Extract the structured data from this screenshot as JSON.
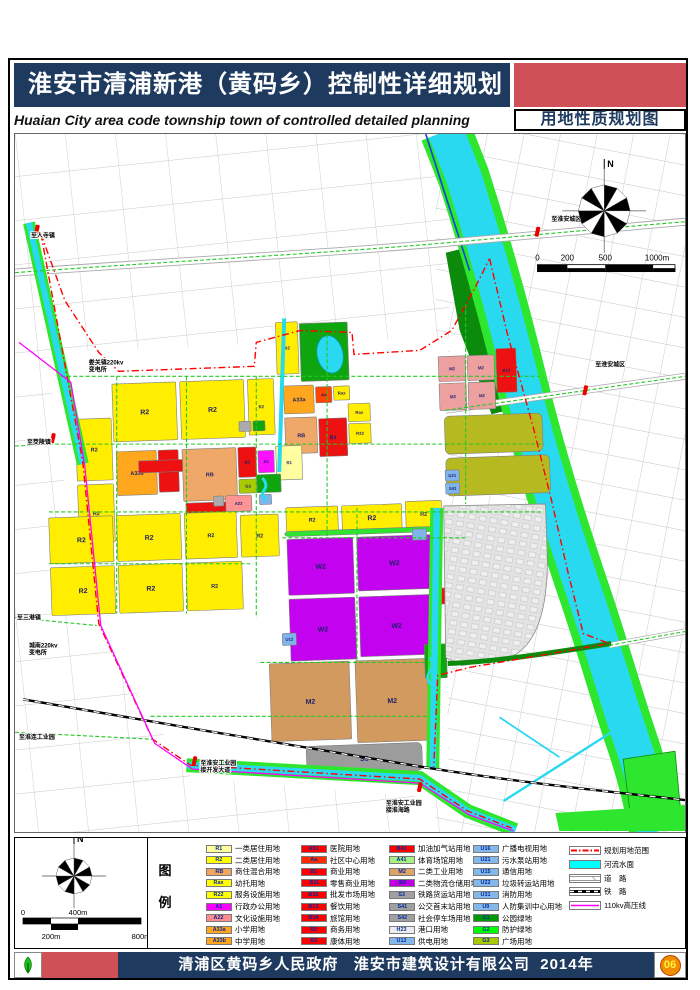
{
  "header": {
    "title_cn": "淮安市清浦新港（黄码乡）控制性详细规划",
    "title_en": "Huaian City area code township town of controlled detailed planning",
    "map_type_label": "用地性质规划图"
  },
  "legend": {
    "panel_chars": [
      "图",
      "例"
    ],
    "north_label": "N",
    "scalebar": {
      "top_labels": [
        {
          "t": "0",
          "x": 8
        },
        {
          "t": "400m",
          "x": 63
        }
      ],
      "bottom_labels": [
        {
          "t": "200m",
          "x": 36
        },
        {
          "t": "800m",
          "x": 126
        }
      ]
    },
    "columns": [
      [
        {
          "code": "R1",
          "label": "一类居住用地",
          "color": "#FFFF9C"
        },
        {
          "code": "R2",
          "label": "二类居住用地",
          "color": "#FFFF00"
        },
        {
          "code": "RB",
          "label": "商住混合用地",
          "color": "#F0A661"
        },
        {
          "code": "Rax",
          "label": "幼托用地",
          "color": "#FFFF00"
        },
        {
          "code": "R22",
          "label": "服务设施用地",
          "color": "#FFFF00"
        },
        {
          "code": "A1",
          "label": "行政办公用地",
          "color": "#FF00FF"
        },
        {
          "code": "A22",
          "label": "文化设施用地",
          "color": "#FF8C8C"
        },
        {
          "code": "A33a",
          "label": "小学用地",
          "color": "#FFA61C"
        },
        {
          "code": "A33b",
          "label": "中学用地",
          "color": "#FFA61C"
        }
      ],
      [
        {
          "code": "A51",
          "label": "医院用地",
          "color": "#FF0000"
        },
        {
          "code": "Aa",
          "label": "社区中心用地",
          "color": "#FF2A00"
        },
        {
          "code": "B1",
          "label": "商业用地",
          "color": "#FF0000"
        },
        {
          "code": "B11",
          "label": "零售商业用地",
          "color": "#FF0000"
        },
        {
          "code": "B12",
          "label": "批发市场用地",
          "color": "#FF0000"
        },
        {
          "code": "B13",
          "label": "餐饮用地",
          "color": "#FF0000"
        },
        {
          "code": "B14",
          "label": "旅馆用地",
          "color": "#FF0000"
        },
        {
          "code": "B2",
          "label": "商务用地",
          "color": "#FF0000"
        },
        {
          "code": "B3",
          "label": "康体用地",
          "color": "#FF0000"
        }
      ],
      [
        {
          "code": "B41",
          "label": "加油加气站用地",
          "color": "#FF0000"
        },
        {
          "code": "A41",
          "label": "体育场馆用地",
          "color": "#A8F080"
        },
        {
          "code": "M2",
          "label": "二类工业用地",
          "color": "#DFA269"
        },
        {
          "code": "W2",
          "label": "二类物流仓储用地",
          "color": "#C000E0"
        },
        {
          "code": "S3",
          "label": "铁路货运站用地",
          "color": "#A0A0A0"
        },
        {
          "code": "S41",
          "label": "公交首末站用地",
          "color": "#A0A0A0"
        },
        {
          "code": "S42",
          "label": "社会停车场用地",
          "color": "#A0A0A0"
        },
        {
          "code": "H23",
          "label": "港口用地",
          "color": "#EDEDED"
        },
        {
          "code": "U12",
          "label": "供电用地",
          "color": "#85B8EA"
        }
      ],
      [
        {
          "code": "U16",
          "label": "广播电视用地",
          "color": "#85B8EA"
        },
        {
          "code": "U21",
          "label": "污水泵站用地",
          "color": "#85B8EA"
        },
        {
          "code": "U15",
          "label": "通信用地",
          "color": "#85B8EA"
        },
        {
          "code": "U22",
          "label": "垃圾转运站用地",
          "color": "#85B8EA"
        },
        {
          "code": "U31",
          "label": "消防用地",
          "color": "#85B8EA"
        },
        {
          "code": "U9",
          "label": "人防集训中心用地",
          "color": "#85B8EA"
        },
        {
          "code": "G1",
          "label": "公园绿地",
          "color": "#009B00"
        },
        {
          "code": "G2",
          "label": "防护绿地",
          "color": "#00FF00"
        },
        {
          "code": "G3",
          "label": "广场用地",
          "color": "#A8C800"
        }
      ]
    ],
    "line_items": [
      {
        "type": "dashdot",
        "label": "规划用地范围"
      },
      {
        "type": "water",
        "label": "河流水面"
      },
      {
        "type": "road",
        "label": "道　路"
      },
      {
        "type": "rail",
        "label": "铁　路"
      },
      {
        "type": "hv",
        "label": "110kv高压线"
      }
    ]
  },
  "map": {
    "north_label": "N",
    "scalebar_labels": [
      {
        "t": "0",
        "x": 538
      },
      {
        "t": "200",
        "x": 568
      },
      {
        "t": "500",
        "x": 606
      },
      {
        "t": "1000m",
        "x": 658
      }
    ],
    "edge_labels": [
      {
        "x": 30,
        "y": 237,
        "lines": [
          "至人寺镇"
        ],
        "mx": 36,
        "my": 229
      },
      {
        "x": 88,
        "y": 364,
        "lines": [
          "娄关镇220kv",
          "变电所"
        ]
      },
      {
        "x": 26,
        "y": 444,
        "lines": [
          "至茭陵镇"
        ],
        "mx": 52,
        "my": 438
      },
      {
        "x": 16,
        "y": 620,
        "lines": [
          "至三港镇"
        ]
      },
      {
        "x": 28,
        "y": 648,
        "lines": [
          "城南220kv",
          "变电所"
        ]
      },
      {
        "x": 18,
        "y": 740,
        "lines": [
          "至淮连工业园"
        ]
      },
      {
        "x": 200,
        "y": 766,
        "lines": [
          "至淮安工业园",
          "接开发大道"
        ],
        "mx": 194,
        "my": 762
      },
      {
        "x": 386,
        "y": 806,
        "lines": [
          "至淮安工业园",
          "接淮海路"
        ],
        "mx": 420,
        "my": 788
      },
      {
        "x": 552,
        "y": 220,
        "lines": [
          "至淮安城区"
        ],
        "mx": 538,
        "my": 231
      },
      {
        "x": 596,
        "y": 366,
        "lines": [
          "至淮安城区"
        ],
        "mx": 586,
        "my": 390
      }
    ],
    "parcels": [
      [
        116,
        378,
        64,
        58,
        "#FFEE00",
        "R2"
      ],
      [
        184,
        378,
        64,
        58,
        "#FFEE00",
        "R2"
      ],
      [
        252,
        378,
        26,
        56,
        "#FFEE00",
        "R2"
      ],
      [
        242,
        420,
        12,
        10,
        "#ABABAB",
        ""
      ],
      [
        256,
        420,
        12,
        10,
        "#0FA50F",
        ""
      ],
      [
        282,
        322,
        22,
        52,
        "#FFEE00",
        "R2"
      ],
      [
        306,
        324,
        48,
        58,
        "#0FA50F",
        "G1"
      ],
      [
        288,
        386,
        30,
        28,
        "#FFA81E",
        "A33a"
      ],
      [
        320,
        388,
        16,
        16,
        "#FF4400",
        "Aa"
      ],
      [
        338,
        388,
        16,
        14,
        "#FFEE00",
        "Rax"
      ],
      [
        288,
        418,
        32,
        36,
        "#F0A868",
        "RB"
      ],
      [
        322,
        420,
        28,
        38,
        "#EE1111",
        "B1"
      ],
      [
        352,
        406,
        22,
        18,
        "#FFEE00",
        "Rax"
      ],
      [
        352,
        426,
        22,
        20,
        "#FFEE00",
        "R22"
      ],
      [
        78,
        412,
        36,
        62,
        "#FFEE00",
        "R2"
      ],
      [
        78,
        478,
        36,
        58,
        "#FFEE00",
        "R2"
      ],
      [
        118,
        446,
        40,
        44,
        "#FFA81E",
        "A33a"
      ],
      [
        160,
        446,
        20,
        42,
        "#EE1111",
        "A51"
      ],
      [
        184,
        446,
        54,
        52,
        "#F0A868",
        "RB"
      ],
      [
        240,
        446,
        18,
        30,
        "#EE1111",
        "B2"
      ],
      [
        260,
        450,
        16,
        22,
        "#FF10FF",
        "A1"
      ],
      [
        278,
        446,
        26,
        34,
        "#FFFFA0",
        "R1"
      ],
      [
        140,
        456,
        44,
        12,
        "#EE1111",
        ""
      ],
      [
        186,
        500,
        50,
        12,
        "#EE1111",
        ""
      ],
      [
        240,
        478,
        18,
        14,
        "#AACB00",
        "G3"
      ],
      [
        226,
        494,
        26,
        16,
        "#FF9494",
        "A22"
      ],
      [
        258,
        474,
        24,
        18,
        "#0FA50F",
        ""
      ],
      [
        260,
        494,
        12,
        10,
        "#7FB4EC",
        ""
      ],
      [
        214,
        494,
        10,
        10,
        "#ABABAB",
        ""
      ],
      [
        48,
        510,
        64,
        46,
        "#FFEE00",
        "R2"
      ],
      [
        116,
        510,
        64,
        46,
        "#FFEE00",
        "R2"
      ],
      [
        184,
        510,
        52,
        46,
        "#FFEE00",
        "R2"
      ],
      [
        240,
        514,
        38,
        42,
        "#FFEE00",
        "R2"
      ],
      [
        48,
        560,
        64,
        48,
        "#FFEE00",
        "R2"
      ],
      [
        116,
        560,
        64,
        48,
        "#FFEE00",
        "R2"
      ],
      [
        184,
        560,
        56,
        48,
        "#FFEE00",
        "R2"
      ],
      [
        286,
        508,
        52,
        26,
        "#FFEE00",
        "R2"
      ],
      [
        342,
        508,
        60,
        26,
        "#FFEE00",
        "R2"
      ],
      [
        406,
        506,
        36,
        26,
        "#FFEE00",
        "R2"
      ],
      [
        284,
        532,
        148,
        5,
        "#2FE62F",
        ""
      ],
      [
        286,
        540,
        66,
        56,
        "#C303F0",
        "W2"
      ],
      [
        356,
        540,
        74,
        54,
        "#C303F0",
        "W2"
      ],
      [
        286,
        600,
        66,
        62,
        "#C303F0",
        "W2"
      ],
      [
        356,
        600,
        74,
        60,
        "#C303F0",
        "W2"
      ],
      [
        432,
        594,
        12,
        16,
        "#EE1111",
        "B41"
      ],
      [
        278,
        634,
        14,
        12,
        "#7FB4EC",
        "U12"
      ],
      [
        412,
        534,
        14,
        11,
        "#7FB4EC",
        ""
      ],
      [
        264,
        664,
        80,
        78,
        "#D29A5E",
        "M2"
      ],
      [
        350,
        664,
        72,
        82,
        "#D29A5E",
        "M2"
      ],
      [
        298,
        748,
        116,
        28,
        "#9C9C9C",
        "S3"
      ],
      [
        444,
        362,
        27,
        25,
        "#ECA0A0",
        "M2"
      ],
      [
        473,
        362,
        27,
        25,
        "#ECA0A0",
        "M2"
      ],
      [
        444,
        389,
        27,
        27,
        "#ECA0A0",
        "M2"
      ],
      [
        473,
        389,
        27,
        27,
        "#ECA0A0",
        "M2"
      ],
      [
        502,
        356,
        20,
        44,
        "#EE1111",
        "B12"
      ],
      [
        448,
        422,
        98,
        38,
        "#B6BA20",
        ""
      ],
      [
        448,
        464,
        104,
        38,
        "#B6BA20",
        ""
      ],
      [
        447,
        476,
        14,
        11,
        "#7FB4EC",
        "U21"
      ],
      [
        447,
        489,
        14,
        11,
        "#7FB4EC",
        "S41"
      ],
      [
        420,
        650,
        22,
        34,
        "#0FA50F",
        "G1"
      ]
    ]
  },
  "footer": {
    "gov": "清浦区黄码乡人民政府",
    "designer": "淮安市建筑设计有限公司",
    "year": "2014年",
    "page_number": "06"
  }
}
